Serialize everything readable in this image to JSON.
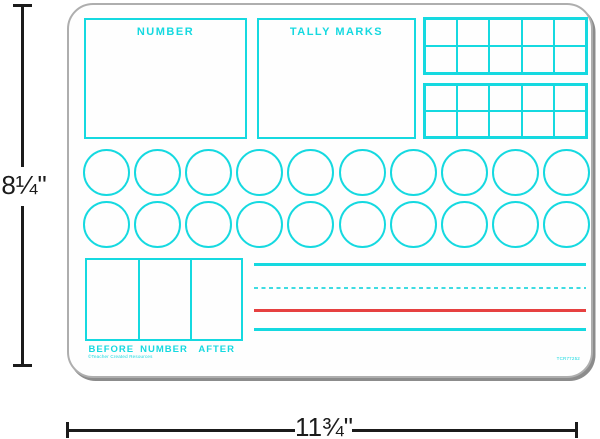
{
  "board": {
    "sections": {
      "number_label": "NUMBER",
      "tally_marks_label": "TALLY MARKS"
    },
    "ten_frames": {
      "count": 2,
      "rows": 2,
      "columns": 5
    },
    "counting_circles": {
      "rows": 2,
      "circles_per_row": 10,
      "total": 20
    },
    "before_number_after": {
      "labels": [
        "BEFORE",
        "NUMBER",
        "AFTER"
      ],
      "cells": 3
    },
    "writing_lines": [
      {
        "style": "solid",
        "color": "#15d9e0",
        "height": 3
      },
      {
        "style": "dashed",
        "color": "#3fdce2",
        "height": 2
      },
      {
        "style": "solid",
        "color": "#e64040",
        "height": 3
      },
      {
        "style": "solid",
        "color": "#15d9e0",
        "height": 3
      }
    ],
    "fine_print_left": "©Teacher Created Resources",
    "fine_print_right": "TCR77252"
  },
  "dimension_callouts": {
    "height": "8¼\"",
    "width": "11¾\""
  },
  "colors": {
    "accent_cyan": "#15d9e0",
    "accent_red": "#e64040",
    "dimension_black": "#1b1b1b",
    "board_border_gray": "#aeaeae"
  }
}
